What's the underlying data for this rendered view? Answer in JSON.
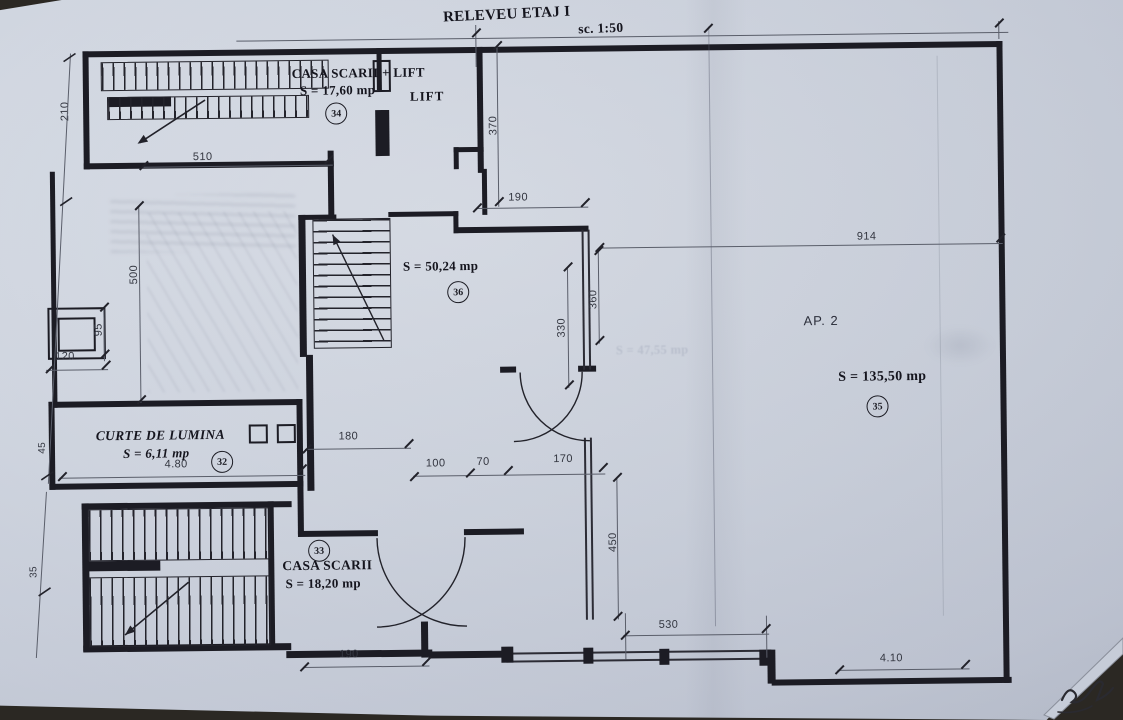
{
  "title": {
    "text": "RELEVEU ETAJ I",
    "scale": "sc. 1:50"
  },
  "rooms": {
    "stair_lift": {
      "name": "CASA SCARII + LIFT",
      "area": "S = 17,60 mp",
      "number": "34"
    },
    "lift": {
      "name": "LIFT"
    },
    "hall": {
      "area": "S = 50,24 mp",
      "number": "36"
    },
    "ap2": {
      "name": "AP. 2",
      "area": "S = 135,50 mp",
      "number": "35"
    },
    "curte": {
      "name": "CURTE DE LUMINA",
      "area": "S = 6,11 mp",
      "number": "32"
    },
    "stair": {
      "name": "CASA SCARII",
      "area": "S = 18,20 mp",
      "number": "33"
    }
  },
  "dimensions": {
    "d210": "210",
    "d510": "510",
    "d370": "370",
    "d190_top": "190",
    "d914": "914",
    "d500": "500",
    "d95": "95",
    "d120": "120",
    "d330": "330",
    "d360": "360",
    "d480": "4.80",
    "d180": "180",
    "d100": "100",
    "d70": "70",
    "d170": "170",
    "d45": "45",
    "d35": "35",
    "d450": "450",
    "d530": "530",
    "d190_bottom": "190",
    "d410": "4.10"
  },
  "artifacts": {
    "ghost_area_label": "S = 47,55 mp"
  },
  "colors": {
    "paper": "#cdd3de",
    "ink": "#1c1c24",
    "dim_text": "#343741",
    "background": "#2b2823"
  }
}
